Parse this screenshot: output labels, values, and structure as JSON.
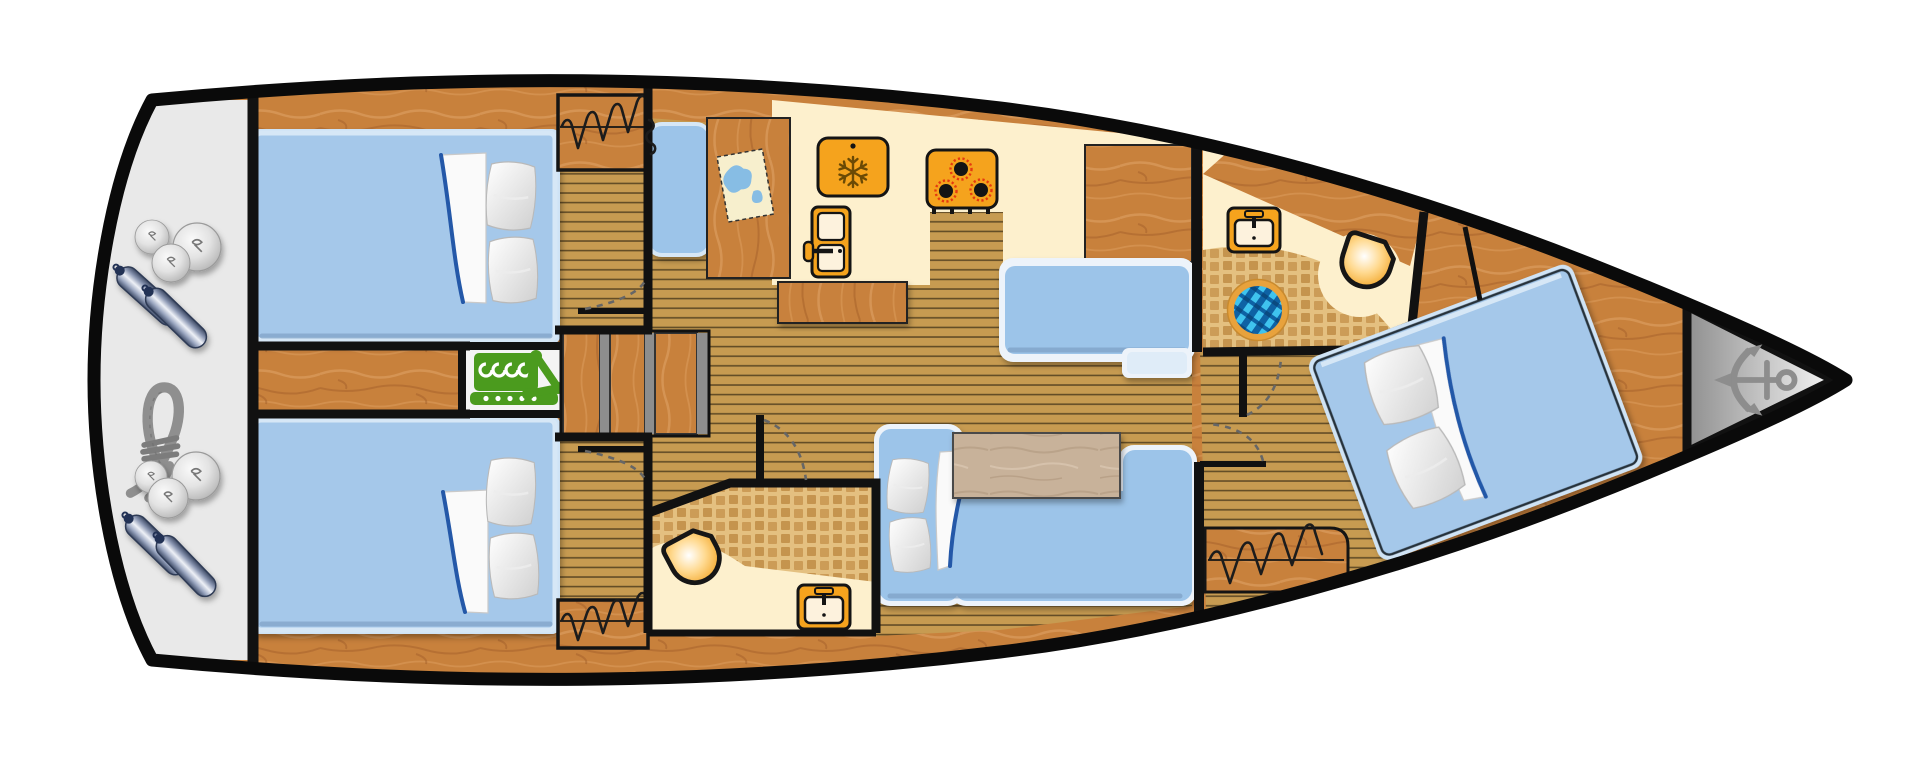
{
  "diagram": {
    "type": "sailing-yacht-interior-floor-plan",
    "view": "top-down",
    "orientation": "bow-right, stern-left",
    "rooms_count": 6
  },
  "colors": {
    "hull_outline": "#0a0a0a",
    "interior_wall": "#111111",
    "wood_trim": "#c8813c",
    "floor_slats": "#c79b51",
    "bathroom_tile": "#e4c080",
    "galley_counter_cream": "#fdf0cd",
    "appliance_orange": "#f5a31d",
    "bed_blue": "#a5c8ea",
    "settee_blue": "#9cc4e9",
    "engine_green": "#4b9b1e",
    "stern_platform_gray": "#e9e9e9",
    "anchor_gray": "#8d8d8d",
    "shower_mosaic_blue": "#0e62a4",
    "table_tan": "#c8b29a",
    "door_swing_arc": "#666666"
  },
  "areas": [
    {
      "name": "stern-platform",
      "items": [
        "fender-balls",
        "cylindrical-fenders",
        "mooring-rope",
        "fender-balls",
        "cylindrical-fenders"
      ]
    },
    {
      "name": "aft-cabin-port",
      "items": [
        "double-bed",
        "two-pillows",
        "duvet",
        "hanging-wardrobe",
        "door-with-swing-arc"
      ]
    },
    {
      "name": "engine-compartment",
      "items": [
        "engine"
      ]
    },
    {
      "name": "companionway",
      "items": [
        "three-steps"
      ]
    },
    {
      "name": "aft-cabin-starboard",
      "items": [
        "double-bed",
        "two-pillows",
        "duvet",
        "hanging-wardrobe",
        "door-with-swing-arc"
      ]
    },
    {
      "name": "aft-head",
      "items": [
        "toilet",
        "washbasin",
        "mosaic-floor",
        "door-with-swing-arc"
      ]
    },
    {
      "name": "galley",
      "items": [
        "refrigerator-snowflake",
        "three-burner-stove",
        "fridge-front-door",
        "counter"
      ]
    },
    {
      "name": "nav-station",
      "items": [
        "seat",
        "chart-table",
        "sea-chart"
      ]
    },
    {
      "name": "salon",
      "items": [
        "upper-settee",
        "lower-settee",
        "saloon-table",
        "wood-table",
        "two-pillows",
        "duvet"
      ]
    },
    {
      "name": "fwd-head",
      "items": [
        "washbasin",
        "round-shower",
        "toilet",
        "mosaic-floor",
        "door-with-swing-arc"
      ]
    },
    {
      "name": "fwd-cabin",
      "items": [
        "angled-double-bed",
        "two-pillows",
        "duvet",
        "hanging-wardrobe",
        "door-with-swing-arc"
      ]
    },
    {
      "name": "anchor-locker",
      "items": [
        "anchor"
      ]
    }
  ]
}
